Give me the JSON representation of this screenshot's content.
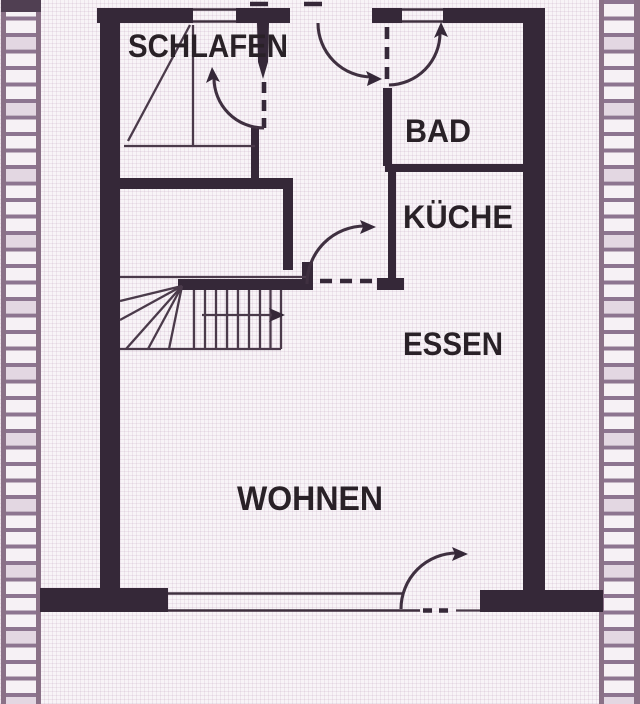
{
  "meta": {
    "description": "Scanned architectural floor plan of a terraced house storey (German room labels)",
    "language": "de"
  },
  "rooms": {
    "schlafen": {
      "label": "SCHLAFEN"
    },
    "bad": {
      "label": "BAD"
    },
    "kueche": {
      "label": "KÜCHE"
    },
    "essen": {
      "label": "ESSEN"
    },
    "wohnen": {
      "label": "WOHNEN"
    }
  },
  "colors": {
    "ink": "#352838",
    "thin_line": "#4a3a4a",
    "hatch_rail": "#8a7187",
    "hatch_rung": "#8d7590",
    "hatch_shaded_brick": "#e3d7e2",
    "paper": "#f8f4f7",
    "grid_line": "#eadfe9",
    "label_text": "#292127"
  }
}
